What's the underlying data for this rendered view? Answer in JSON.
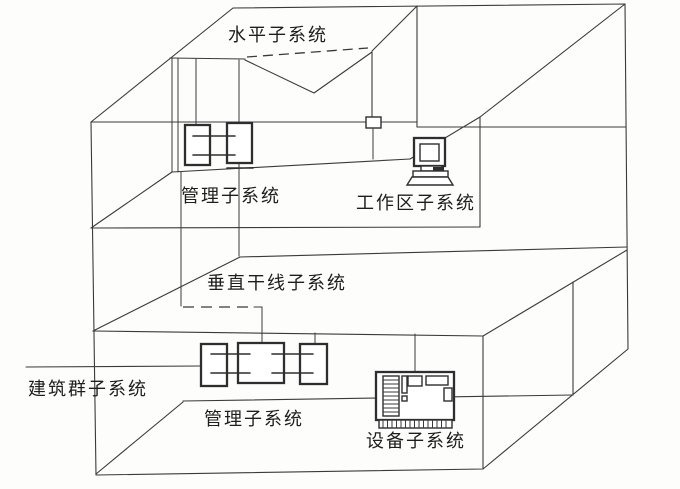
{
  "diagram": {
    "type": "structured-cabling-building-diagram",
    "labels": {
      "horizontal": "水平子系统",
      "management_upper": "管理子系统",
      "work_area": "工作区子系统",
      "vertical_backbone": "垂直干线子系统",
      "campus": "建筑群子系统",
      "management_lower": "管理子系统",
      "equipment": "设备子系统"
    },
    "colors": {
      "line": "#3a3a3a",
      "background": "#fdfdfc",
      "text": "#1e1e1e"
    }
  }
}
